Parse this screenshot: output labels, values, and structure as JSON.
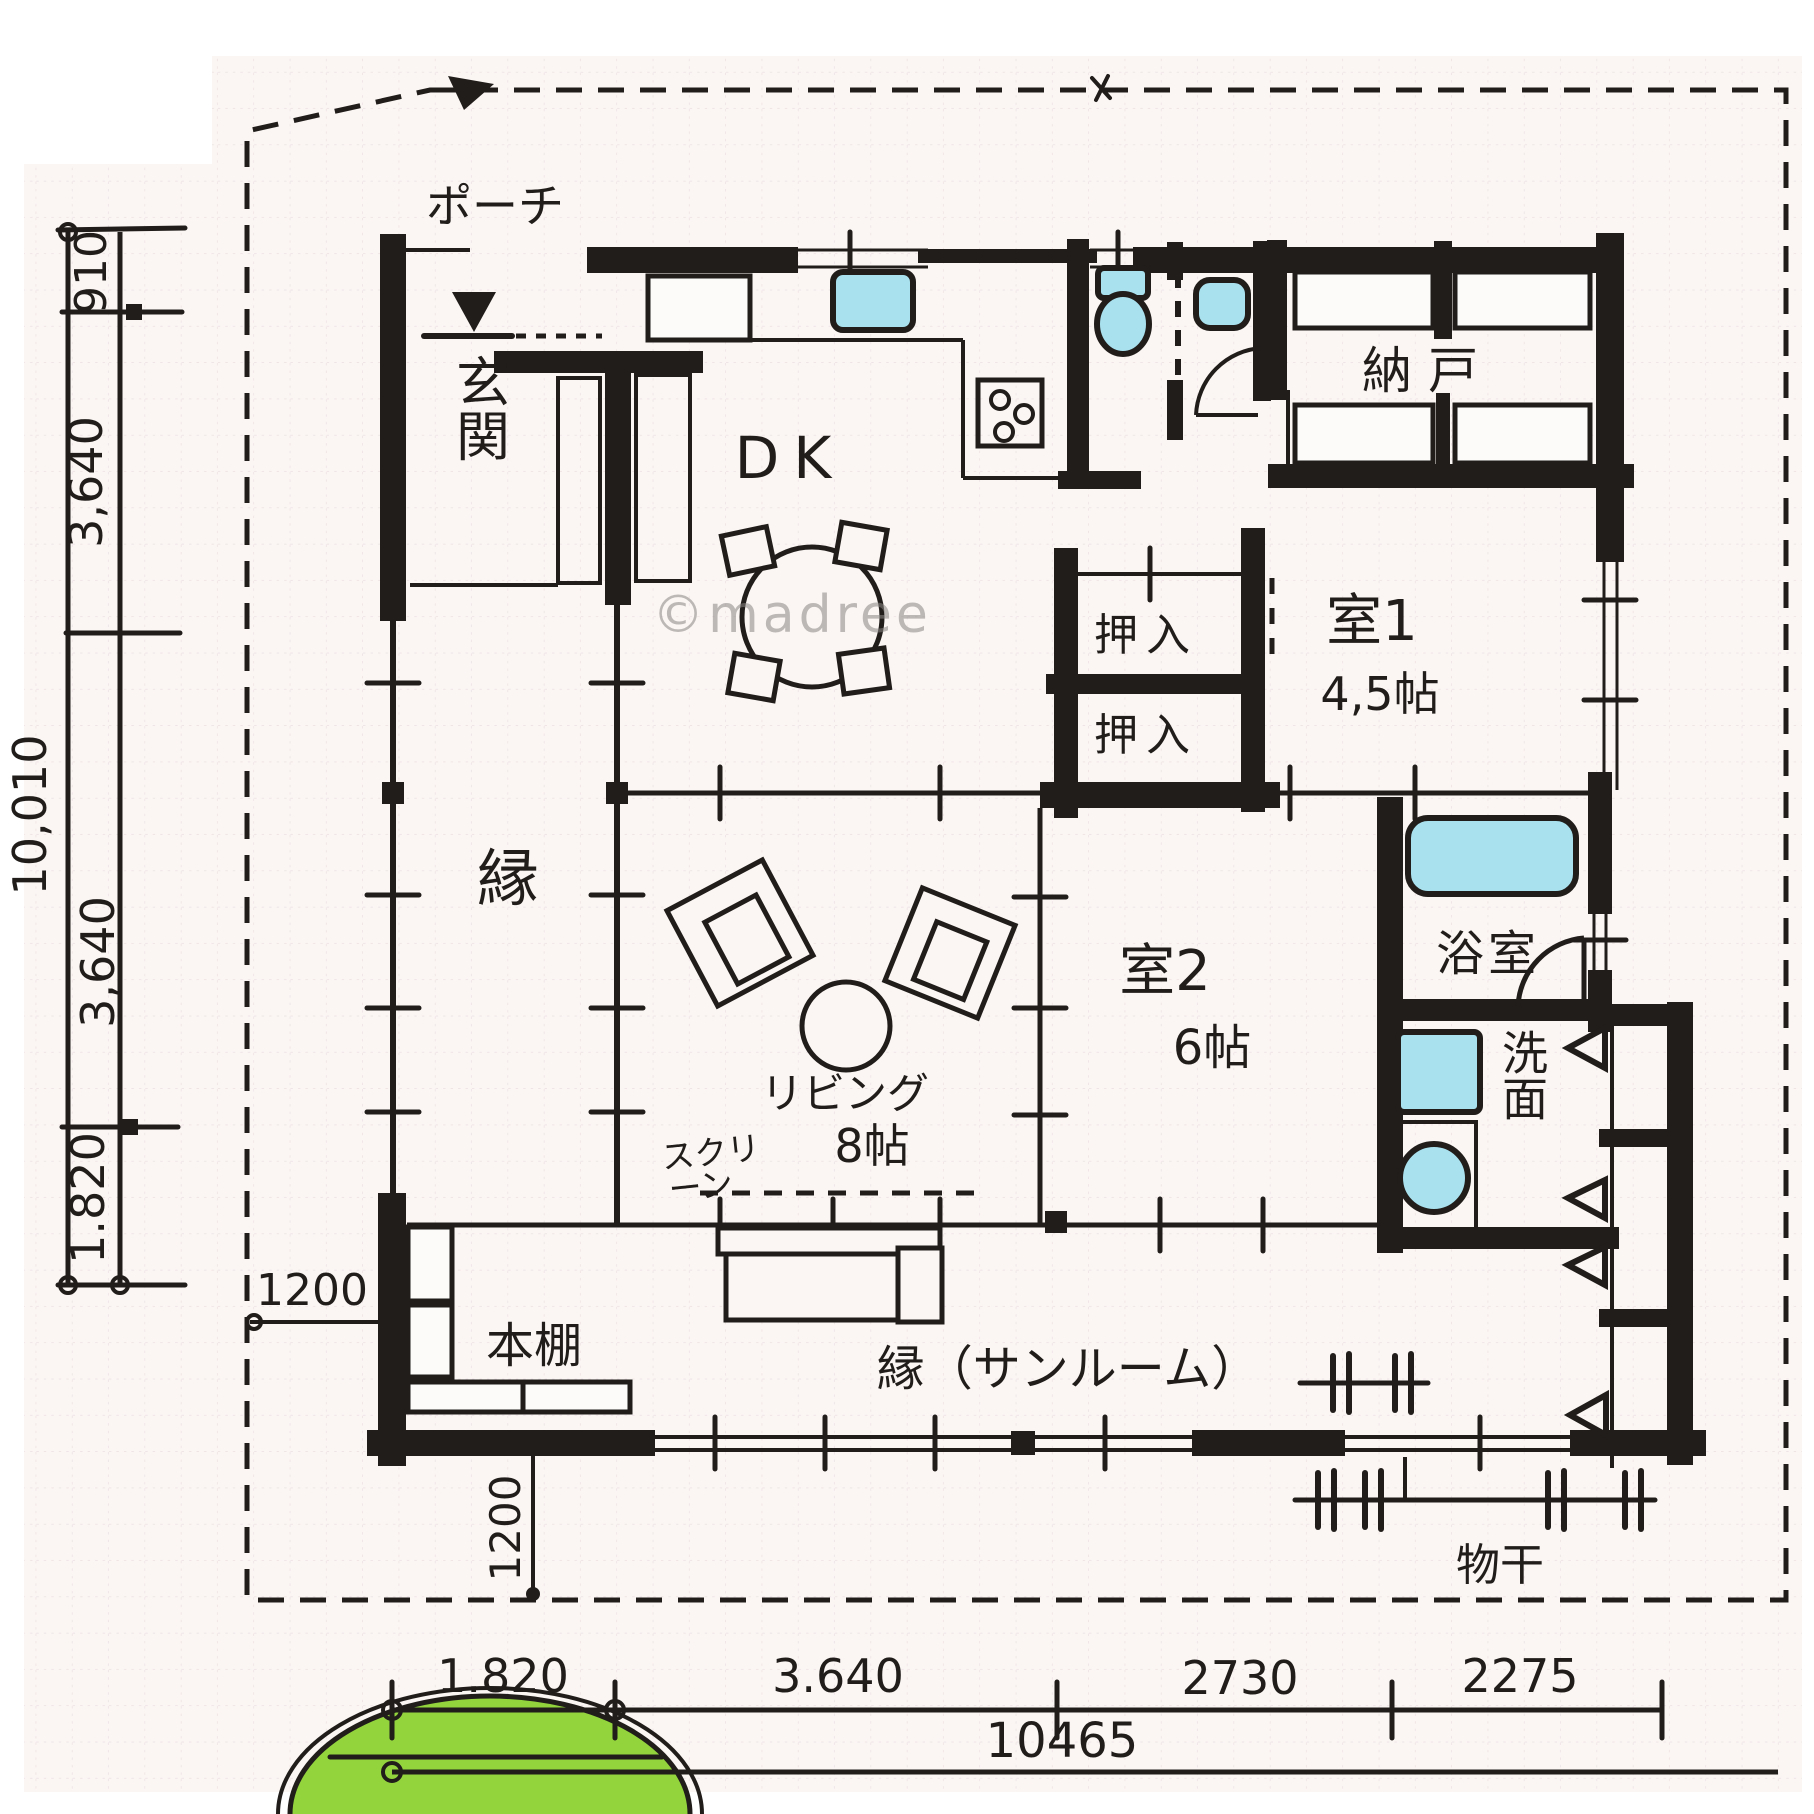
{
  "watermark": "©madree",
  "labels": {
    "porch": "ポーチ",
    "entrance": "玄関",
    "dk": "DK",
    "storeroom": "納 戸",
    "closet_upper": "押入",
    "closet_lower": "押入",
    "room1": "室1",
    "room1_size": "4,5帖",
    "room2": "室2",
    "room2_size": "6帖",
    "living": "リビング",
    "living_size": "8帖",
    "veranda": "縁",
    "bath": "浴室",
    "washroom": "洗面",
    "sunroom": "縁（サンルーム）",
    "bookshelf": "本棚",
    "drying": "物干",
    "screen_line1": "スクリ",
    "screen_line2": "ーン"
  },
  "dimensions": {
    "left": {
      "segments": [
        "910",
        "3,640",
        "3,640",
        "1.820"
      ],
      "total": "10,010"
    },
    "bottom": {
      "segments": [
        "1.820",
        "3.640",
        "2730",
        "2275"
      ],
      "total": "10465"
    },
    "bookshelf_width": "1200",
    "bookshelf_depth": "1200"
  },
  "colors": {
    "ink": "#201d1b",
    "fixture_water": "#a9e1ee",
    "shrub_green": "#8dd233",
    "paper": "#fbf6f4",
    "grid": "#decbd3",
    "watermark": "#8a8684"
  }
}
